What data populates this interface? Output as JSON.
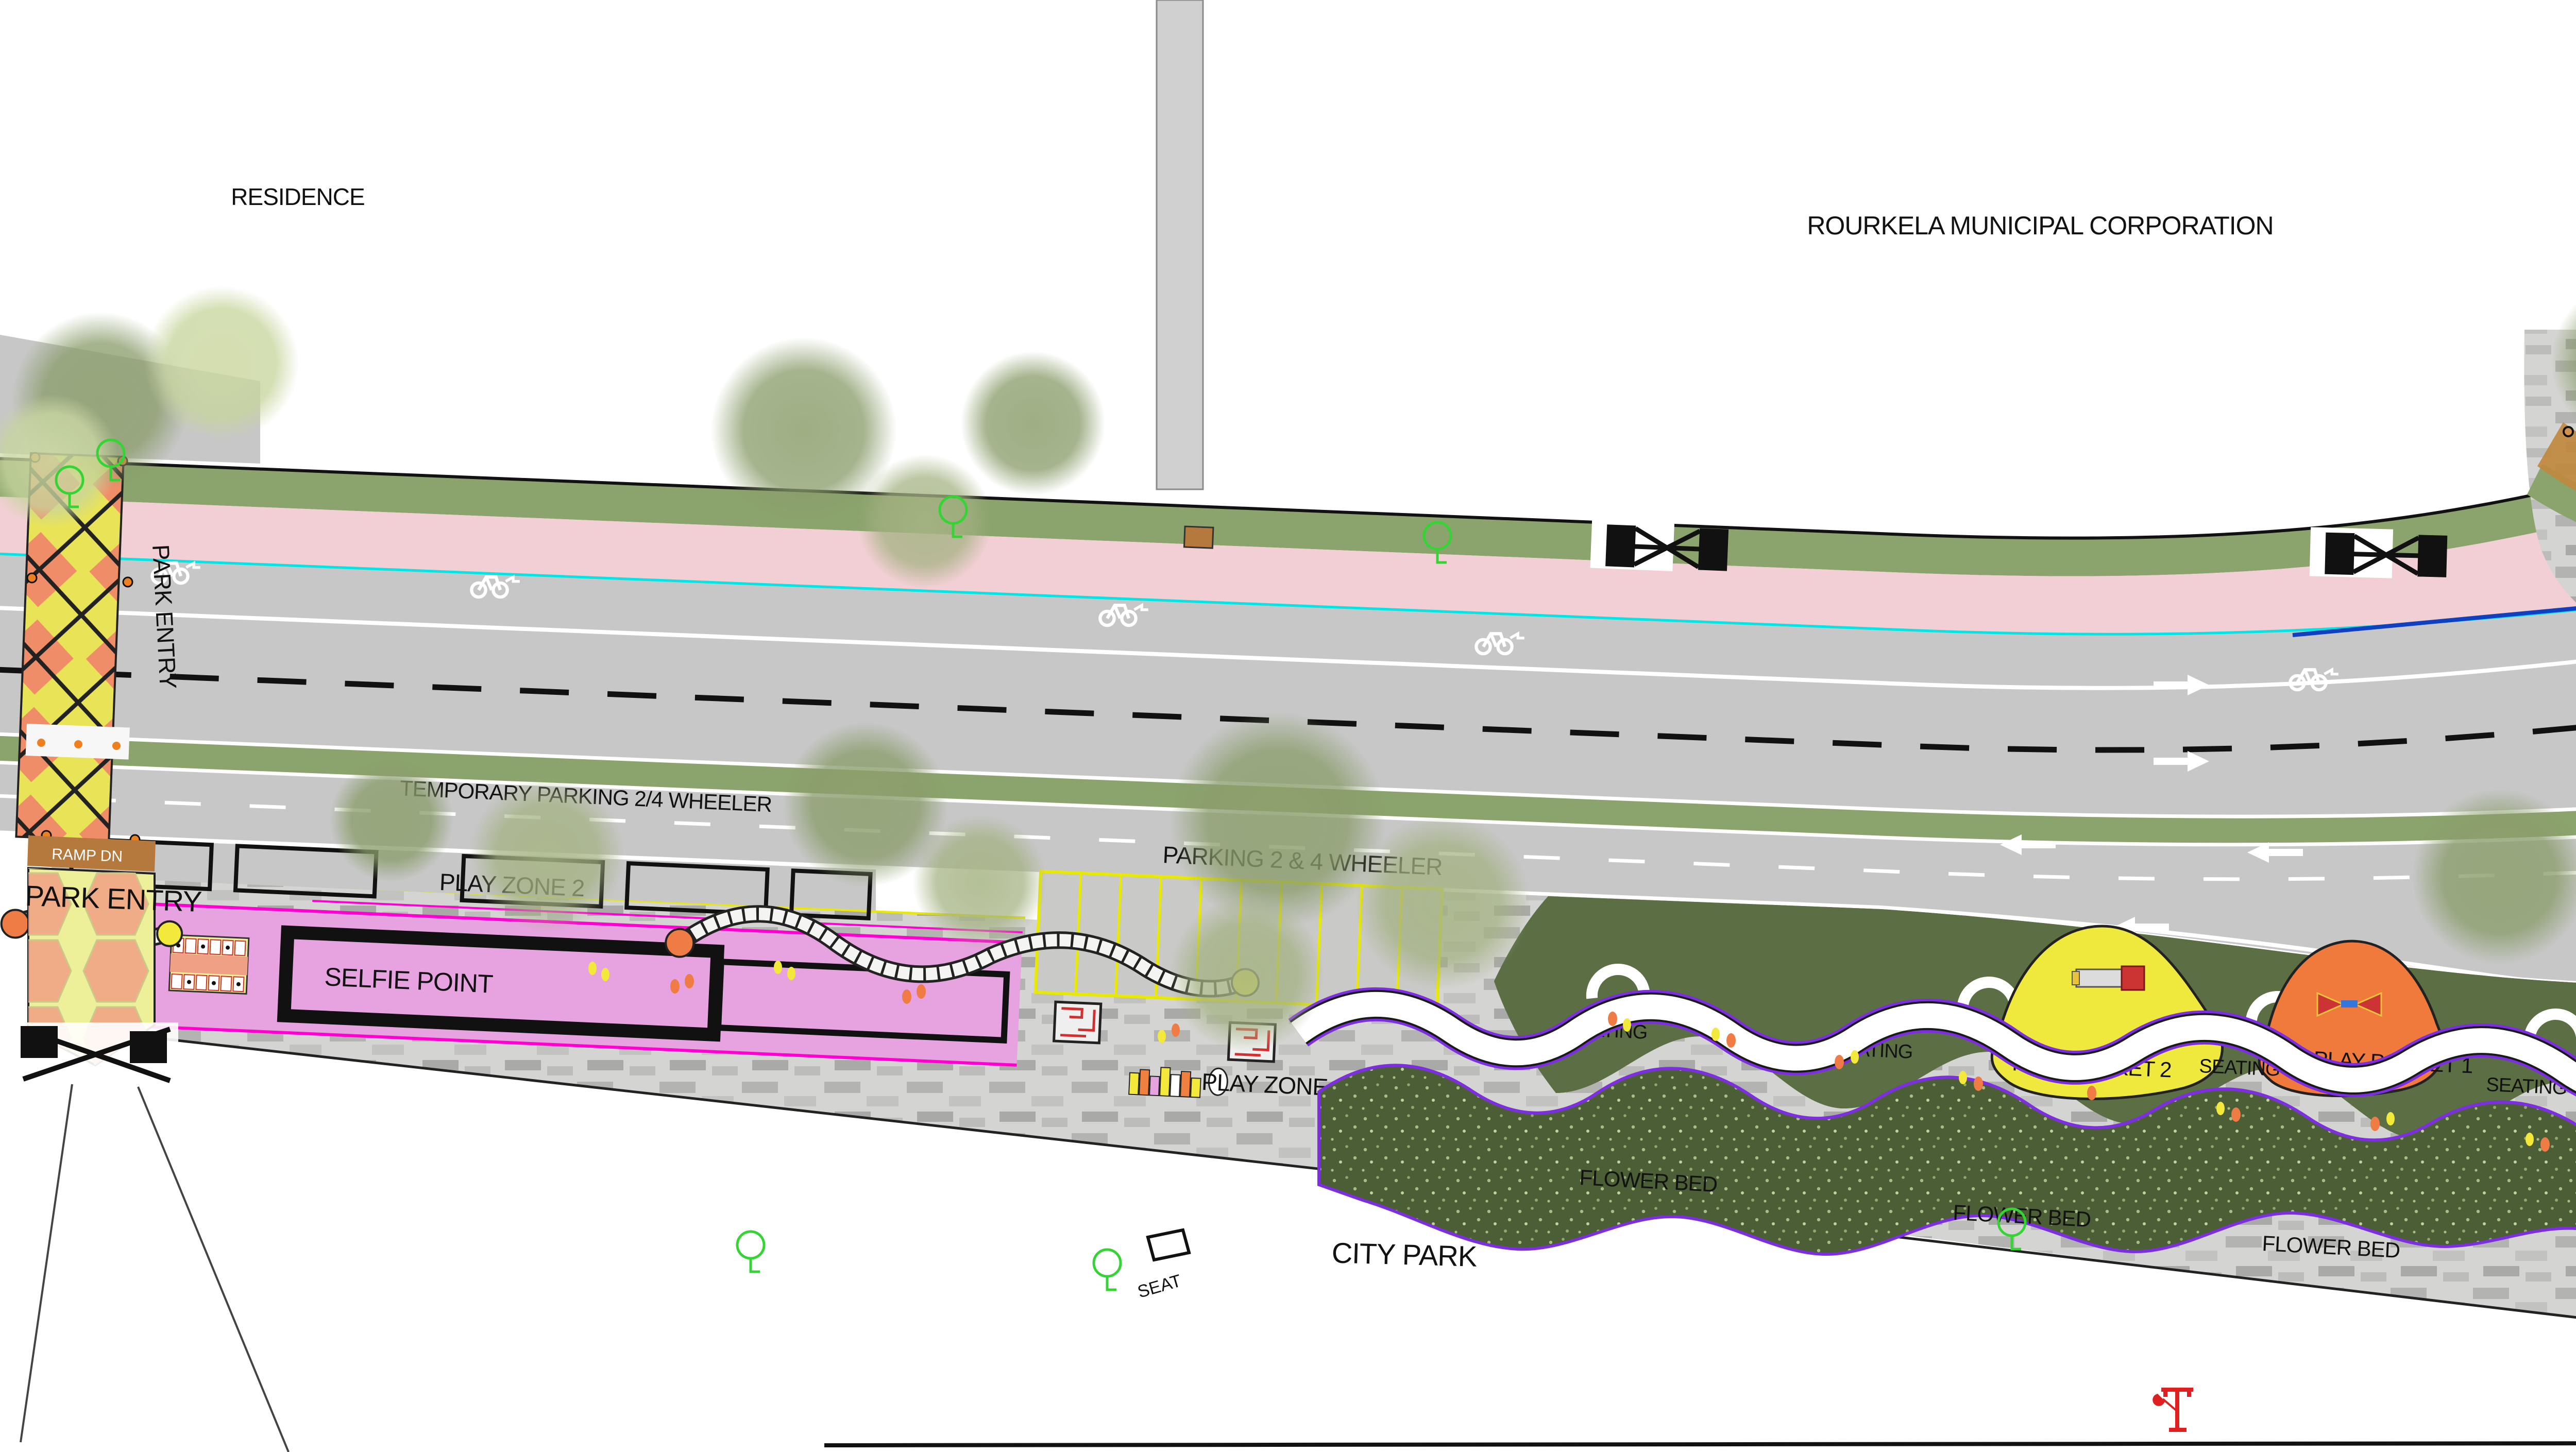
{
  "title": "Rourkela street redesign site plan",
  "labels": {
    "residence": "RESIDENCE",
    "municipal": "ROURKELA MUNICIPAL CORPORATION",
    "tea_shop": "TEA SHOP",
    "temple": "TEMPLE",
    "city_park": "CITY PARK",
    "seat": "SEAT",
    "park_entry": "PARK ENTRY",
    "ramp_dn": "RAMP DN",
    "ramp": "RAMP",
    "selfie_point": "SELFIE POINT",
    "play_zone_1": "PLAY ZONE 1",
    "play_zone_2": "PLAY ZONE 2",
    "play_pocket_1": "PLAY POCKET 1",
    "play_pocket_2": "PLAY POCKET 2",
    "temporary_parking": "TEMPORARY PARKING 2/4 WHEELER",
    "parking": "PARKING 2 & 4 WHEELER",
    "flower_bed": "FLOWER BED",
    "seating": "SEATING",
    "stop": "STOP",
    "walkway": "WALKWAY 1.8M"
  },
  "colors": {
    "road": "#c7c7c7",
    "sidewalk_pink": "#f2cfd4",
    "verge_green": "#8ba36d",
    "median_green": "#8ba36d",
    "curb_cyan": "#00e5e5",
    "curb_blue": "#1040c0",
    "planting_dark": "#5c6e44",
    "flower_bed_green": "#4c5e36",
    "promenade_paver": "#d4d4d2",
    "selfie_zone_violet": "#e7a3e0",
    "magenta_edge": "#ff00d0",
    "purple_edge": "#7d2ee0",
    "play_pocket_2_yellow": "#eee93c",
    "play_pocket_1_orange": "#f0793c",
    "plaza_yellow": "#eef099",
    "plaza_salmon": "#f0a084",
    "ramp_brown": "#b57a3e",
    "corner_tan": "#c0893f",
    "bollard_orange": "#d2914e",
    "temple_border_red": "#e02020",
    "seat_label_pink": "#e8187d",
    "parking_stripe_yellow": "#e8e800"
  }
}
